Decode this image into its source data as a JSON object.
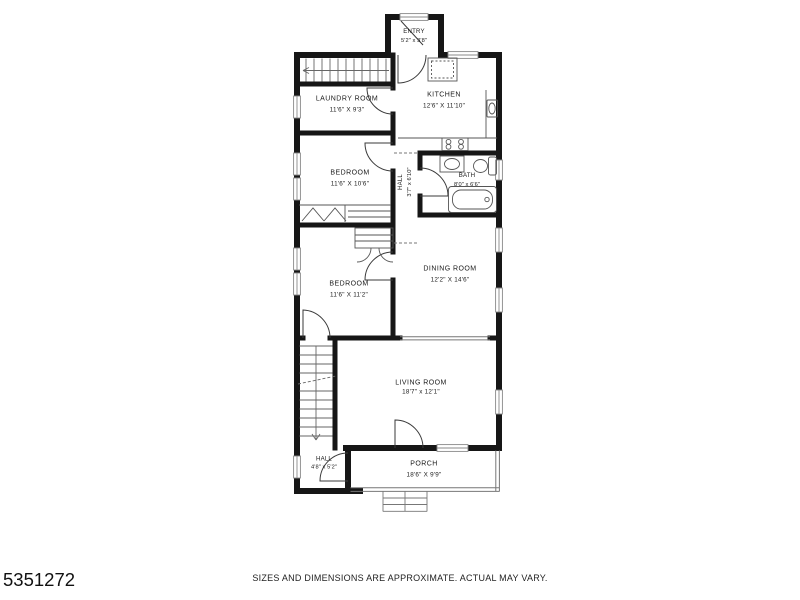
{
  "branding": {
    "listing_id": "5351272"
  },
  "footer": {
    "disclaimer": "SIZES AND DIMENSIONS ARE APPROXIMATE. ACTUAL MAY VARY."
  },
  "rooms": [
    {
      "id": "entry",
      "name": "ENTRY",
      "dims": "5'2\" x 3'8\""
    },
    {
      "id": "laundry",
      "name": "LAUNDRY ROOM",
      "dims": "11'6\" X 9'3\""
    },
    {
      "id": "kitchen",
      "name": "KITCHEN",
      "dims": "12'6\" X 11'10\""
    },
    {
      "id": "bedroom1",
      "name": "BEDROOM",
      "dims": "11'6\" X 10'6\""
    },
    {
      "id": "hall1",
      "name": "HALL",
      "dims": "3'7\" x 6'10\""
    },
    {
      "id": "bath",
      "name": "BATH",
      "dims": "8'0\" x 6'6\""
    },
    {
      "id": "bedroom2",
      "name": "BEDROOM",
      "dims": "11'6\" X 11'2\""
    },
    {
      "id": "dining",
      "name": "DINING ROOM",
      "dims": "12'2\" X 14'6\""
    },
    {
      "id": "living",
      "name": "LIVING ROOM",
      "dims": "18'7\" x 12'1\""
    },
    {
      "id": "hall2",
      "name": "HALL",
      "dims": "4'8\" x 5'2\""
    },
    {
      "id": "porch",
      "name": "PORCH",
      "dims": "18'6\" X 9'9\""
    }
  ],
  "colors": {
    "wall": "#161616",
    "fixture_line": "#555555",
    "window_line": "#888888",
    "text": "#1a1a1a",
    "background": "#ffffff"
  }
}
